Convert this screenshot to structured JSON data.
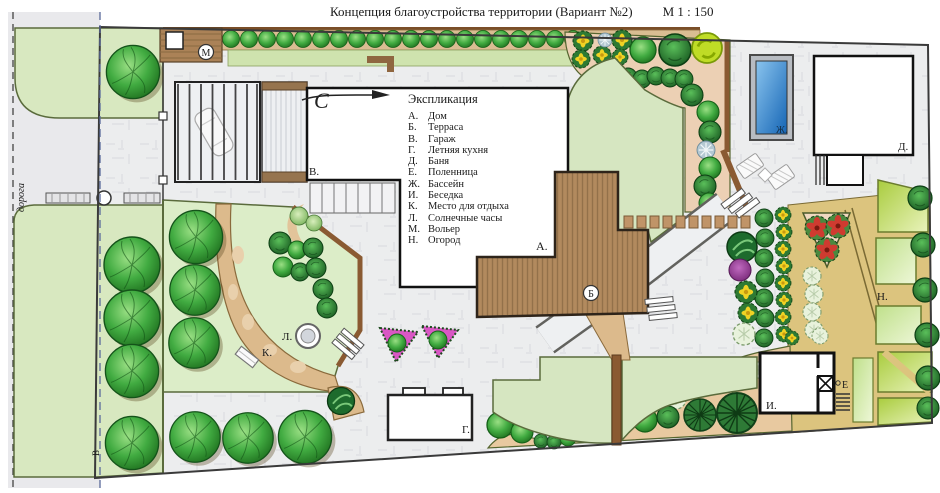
{
  "title": "Концепция  благоустройства  территории  (Вариант №2)",
  "scale": "М 1 : 150",
  "legend": {
    "title": "Экспликация",
    "items": [
      {
        "code": "А.",
        "label": "Дом"
      },
      {
        "code": "Б.",
        "label": "Терраса"
      },
      {
        "code": "В.",
        "label": "Гараж"
      },
      {
        "code": "Г.",
        "label": "Летняя кухня"
      },
      {
        "code": "Д.",
        "label": "Баня"
      },
      {
        "code": "Е.",
        "label": "Поленница"
      },
      {
        "code": "Ж.",
        "label": "Бассейн"
      },
      {
        "code": "И.",
        "label": "Беседка"
      },
      {
        "code": "К.",
        "label": "Место для отдыха"
      },
      {
        "code": "Л.",
        "label": "Солнечные часы"
      },
      {
        "code": "М.",
        "label": "Вольер"
      },
      {
        "code": "Н.",
        "label": "Огород"
      }
    ]
  },
  "plan_labels": {
    "house": "А.",
    "terrace": "Б",
    "garage": "В.",
    "summer_kitchen": "Г.",
    "bathhouse": "Д.",
    "woodpile": "Е",
    "pool": "Ж.",
    "gazebo": "И.",
    "rest_area": "К.",
    "sundial": "Л.",
    "aviary": "М",
    "garden": "Н.",
    "road": "дорога",
    "axis": "В",
    "north": "С"
  },
  "colors": {
    "lawn": "#d8e8c0",
    "courtyard": "#ecedee",
    "water": "#2b7fc4",
    "terrace_deck": "#b28a5e",
    "soil_path": "#dcba8c",
    "bed_soil": "#ecd0b4",
    "garden_bed": "#c8e060",
    "tree_green": "#37a437",
    "fence_brown": "#8a5a32"
  }
}
